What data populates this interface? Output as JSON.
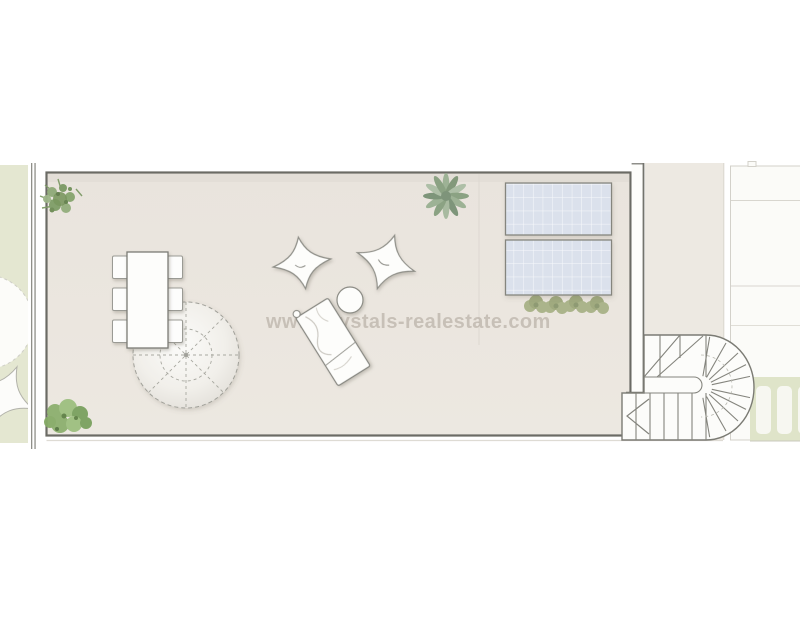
{
  "watermark": {
    "text": "www.crystals-realestate.com"
  },
  "palette": {
    "background": "#ffffff",
    "terrace_floor": "#eae5de",
    "terrace_outline": "#6b6b65",
    "garden_strip": "#e4e7d1",
    "pergola_green": "#dfe4c9",
    "pergola_slat": "#f7f7f1",
    "solar_panel": "#dbe1ec",
    "neighbor_strip": "#ede9e2",
    "neighbor_room": "#fbfbf8",
    "furniture_fill": "#fdfdfb",
    "furniture_outline": "#8a8a83",
    "stair_outline": "#82827b",
    "plant_green": "#86a36d",
    "hedge_olive": "#a6b084",
    "agave_green": "#9db295",
    "watermark_color": "#8f8478"
  },
  "inventory": {
    "dining_chairs": 6,
    "dining_tables": 1,
    "parasols": 1,
    "bean_bags": 2,
    "side_tables": 1,
    "sun_loungers": 1,
    "solar_panels": 2,
    "hedge_bushes": 4,
    "pergola_slats": 3,
    "staircases": 1,
    "corner_plants": 3
  }
}
